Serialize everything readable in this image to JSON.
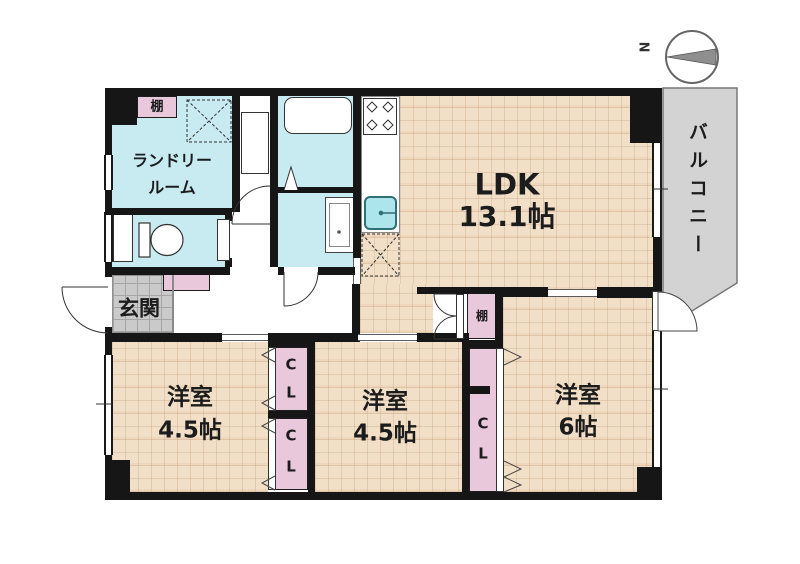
{
  "plan": {
    "ldk": {
      "name": "LDK",
      "size": "13.1帖"
    },
    "bedroom_left": {
      "name": "洋室",
      "size": "4.5帖"
    },
    "bedroom_middle": {
      "name": "洋室",
      "size": "4.5帖"
    },
    "bedroom_right": {
      "name": "洋室",
      "size": "6帖"
    },
    "laundry": {
      "line1": "ランドリー",
      "line2": "ルーム"
    },
    "entrance": {
      "name": "玄関"
    },
    "balcony": {
      "name": "バルコニー"
    },
    "shelf_label": "棚",
    "closet": {
      "c": "C",
      "l": "L"
    },
    "compass_north": "N",
    "colors": {
      "tatami_floor": "#f2dfc8",
      "wet_area": "#c7ebf1",
      "closet_pink": "#eac8db",
      "balcony_gray": "#d3d3d3",
      "entrance_tile": "#cacaca",
      "wall": "#161616"
    }
  }
}
